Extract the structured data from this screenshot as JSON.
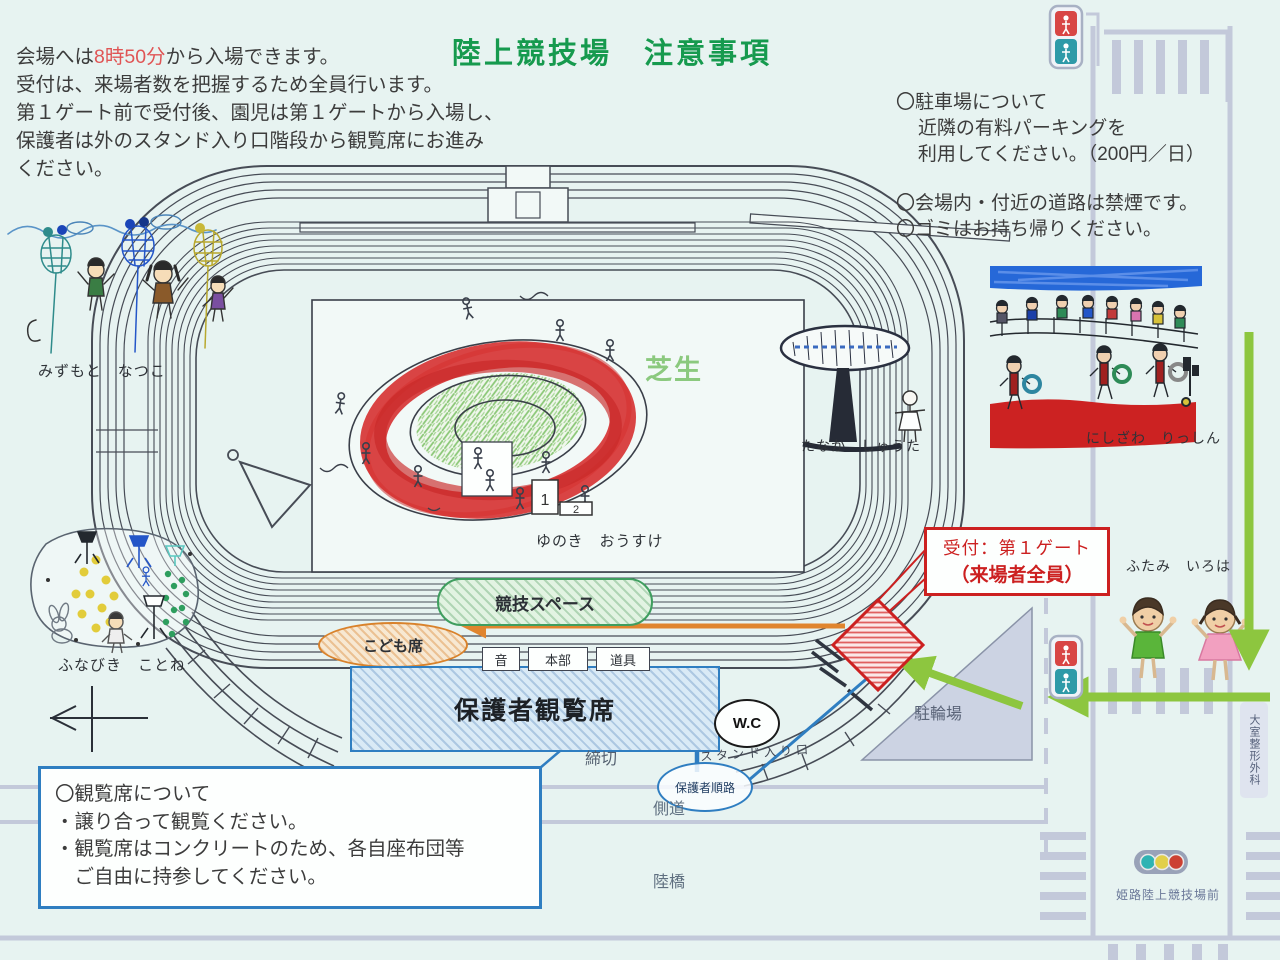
{
  "title": "陸上競技場　注意事項",
  "intro": {
    "line1_pre": "会場へは",
    "line1_time": "8時50分",
    "line1_post": "から入場できます。",
    "lines": [
      "受付は、来場者数を把握するため全員行います。",
      "第１ゲート前で受付後、園児は第１ゲートから入場し、",
      "保護者は外のスタンド入り口階段から観覧席にお進み",
      "ください。"
    ]
  },
  "right_notes": {
    "parking_title": "〇駐車場について",
    "parking_lines": [
      "近隣の有料パーキングを",
      "利用してください。（200円／日）"
    ],
    "rules": [
      "〇会場内・付近の道路は禁煙です。",
      "〇ゴミはお持ち帰りください。"
    ]
  },
  "seating_box": {
    "title": "〇観覧席について",
    "lines": [
      "・譲り合って観覧ください。",
      "・観覧席はコンクリートのため、各自座布団等",
      "　ご自由に持参してください。"
    ]
  },
  "reception": {
    "line1": "受付：第１ゲート",
    "line2": "（来場者全員）"
  },
  "map_labels": {
    "lawn": "芝生",
    "competition_space": "競技スペース",
    "kids_seats": "こども席",
    "guardian_seats": "保護者観覧席",
    "sound": "音",
    "hq": "本部",
    "equipment": "道具",
    "wc": "W.C",
    "guardian_route": "保護者順路",
    "closed": "締切",
    "side_road": "側道",
    "overpass": "陸橋",
    "bicycle_parking": "駐輪場",
    "stand_entrance": "スタンド入り口",
    "clinic": "大室整形外科",
    "bus_stop": "姫路陸上競技場前",
    "podium_first": "1",
    "podium_second": "2"
  },
  "artists": {
    "mizumoto": "みずもと　なつこ",
    "funabiki": "ふなびき　ことね",
    "yunoki": "ゆのき　おうすけ",
    "tanaka": "たなか　しゅうた",
    "nishizawa": "にしざわ　りっしん",
    "futami": "ふたみ　いろは"
  },
  "colors": {
    "title_green": "#169a4e",
    "highlight_red": "#e05555",
    "accent_red": "#cc2020",
    "route_green": "#8dc63f",
    "route_orange": "#e0852e",
    "route_blue": "#2f7ec1",
    "road_gray": "#c3c9da"
  }
}
